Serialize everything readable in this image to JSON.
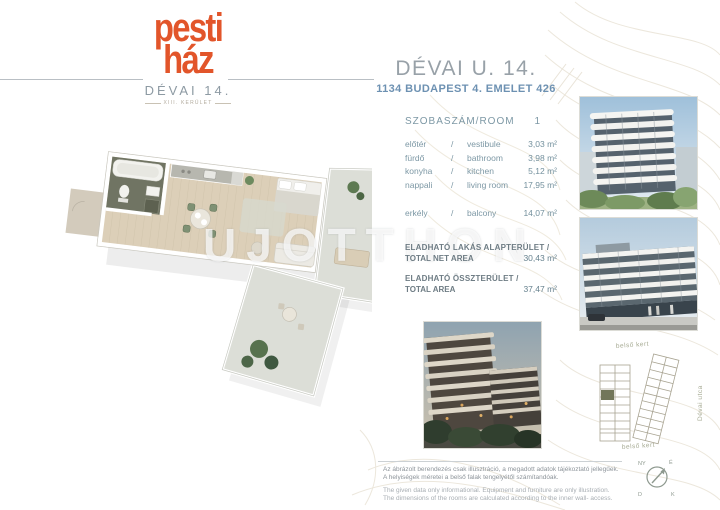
{
  "logo": {
    "word1": "pesti",
    "word2": "ház",
    "project": "DÉVAI 14.",
    "district": "XIII. KERÜLET",
    "accent_color": "#e2552a"
  },
  "header": {
    "title": "DÉVAI U. 14.",
    "subtitle": "1134 BUDAPEST 4. EMELET 426"
  },
  "room_table": {
    "header": "SZOBASZÁM/ROOM",
    "room_count": "1",
    "rows": [
      {
        "hu": "előtér",
        "sep": "/",
        "en": "vestibule",
        "area": "3,03 m²"
      },
      {
        "hu": "fürdő",
        "sep": "/",
        "en": "bathroom",
        "area": "3,98 m²"
      },
      {
        "hu": "konyha",
        "sep": "/",
        "en": "kitchen",
        "area": "5,12 m²"
      },
      {
        "hu": "nappali",
        "sep": "/",
        "en": "living room",
        "area": "17,95 m²"
      },
      {
        "hu": "erkély",
        "sep": "/",
        "en": "balcony",
        "area": "14,07 m²"
      }
    ]
  },
  "totals": {
    "net": {
      "hu": "ELADHATÓ LAKÁS ALAPTERÜLET /",
      "en": "TOTAL NET AREA",
      "value": "30,43 m²"
    },
    "gross": {
      "hu": "ELADHATÓ ÖSSZTERÜLET /",
      "en": "TOTAL AREA",
      "value": "37,47 m²"
    }
  },
  "watermark": "UJOTTHON",
  "site_plan": {
    "garden_top": "belső kert",
    "garden_bottom": "belső kert",
    "street": "Dévai utca"
  },
  "compass": {
    "north": "É",
    "south": "D",
    "east": "K",
    "west": "NY"
  },
  "disclaimer": {
    "hu1": "Az ábrázolt berendezés csak illusztráció, a megadott adatok tájékoztató jellegűek.",
    "hu2": "A helyiségek méretei a belső falak tengelyétől számítandóak.",
    "en1": "The given data only informational. Equipment and furniture are only illustration.",
    "en2": "The dimensions of the rooms are calculated according to the inner wall- access."
  }
}
